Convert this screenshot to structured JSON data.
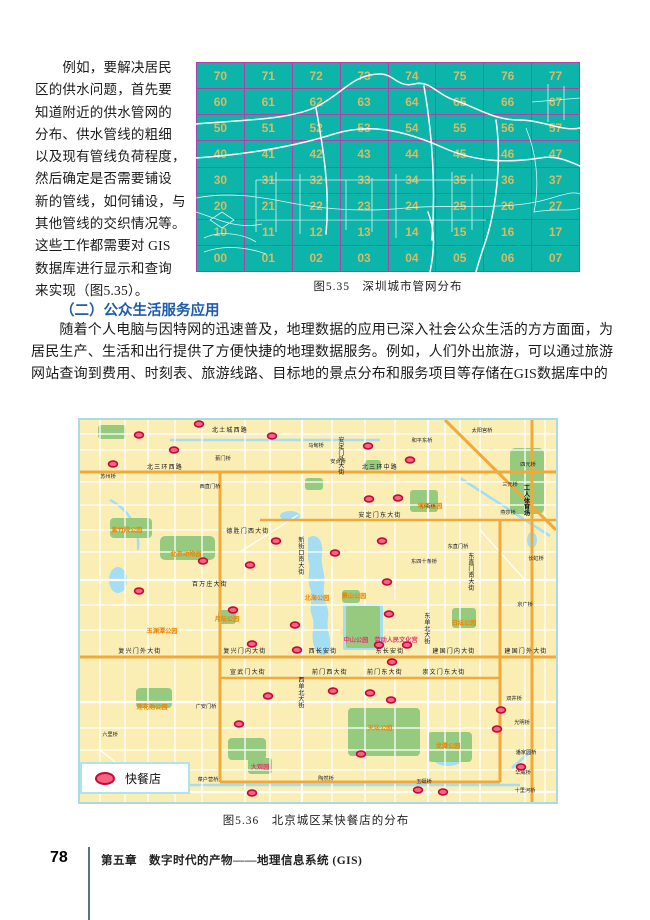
{
  "page": {
    "left_paragraph": "　　例如，要解决居民\n区的供水问题，首先要\n知道附近的供水管网的\n分布、供水管线的粗细\n以及现有管线负荷程度，\n然后确定是否需要铺设\n新的管线，如何铺设，与\n其他管线的交织情况等。\n这些工作都需要对 GIS\n数据库进行显示和查询\n来实现（图5.35）。",
    "section_heading": "（二）公众生活服务应用",
    "paragraph2": "　　随着个人电脑与因特网的迅速普及，地理数据的应用已深入社会公众生活的方方面面，为\n居民生产、生活和出行提供了方便快捷的地理数据服务。例如，人们外出旅游，可以通过旅游\n网站查询到费用、时刻表、旅游线路、目标地的景点分布和服务项目等存储在GIS数据库中的",
    "footer": {
      "page_number": "78",
      "chapter": "第五章　数字时代的产物——地理信息系统 (GIS)"
    }
  },
  "shenzhen_map": {
    "caption": "图5.35　深圳城市管网分布",
    "grid_numbers": [
      [
        "70",
        "71",
        "72",
        "73",
        "74",
        "75",
        "76",
        "77"
      ],
      [
        "60",
        "61",
        "62",
        "63",
        "64",
        "65",
        "66",
        "67"
      ],
      [
        "50",
        "51",
        "52",
        "53",
        "54",
        "55",
        "56",
        "57"
      ],
      [
        "40",
        "41",
        "42",
        "43",
        "44",
        "45",
        "46",
        "47"
      ],
      [
        "30",
        "31",
        "32",
        "33",
        "34",
        "35",
        "36",
        "37"
      ],
      [
        "20",
        "21",
        "22",
        "23",
        "24",
        "25",
        "26",
        "27"
      ],
      [
        "10",
        "11",
        "12",
        "13",
        "14",
        "15",
        "16",
        "17"
      ],
      [
        "00",
        "01",
        "02",
        "03",
        "04",
        "05",
        "06",
        "07"
      ]
    ],
    "colors": {
      "background": "#0cb4aa",
      "grid_line": "#b23fa5",
      "number": "#d4bc66",
      "pipes": "#ffffff"
    }
  },
  "beijing_map": {
    "caption": "图5.36　北京城区某快餐店的分布",
    "legend": {
      "label": "快餐店"
    },
    "colors": {
      "background": "#faeeb5",
      "park": "#96cb7f",
      "water": "#a5ddf3",
      "major_road": "#f2a93b",
      "marker_fill": "#f4647f",
      "marker_stroke": "#c40a3c",
      "park_label": "#f08300",
      "landmark_label": "#e43a6e"
    },
    "street_labels": [
      {
        "t": "北土城西路",
        "x": 150,
        "y": 12
      },
      {
        "t": "北三环西路",
        "x": 85,
        "y": 49
      },
      {
        "t": "北三环中路",
        "x": 300,
        "y": 49
      },
      {
        "t": "安定门东大街",
        "x": 300,
        "y": 97
      },
      {
        "t": "德胜门西大街",
        "x": 168,
        "y": 113
      },
      {
        "t": "百万庄大街",
        "x": 130,
        "y": 166
      },
      {
        "t": "复兴门外大街",
        "x": 60,
        "y": 233
      },
      {
        "t": "复兴门内大街",
        "x": 165,
        "y": 233
      },
      {
        "t": "西长安街",
        "x": 243,
        "y": 233
      },
      {
        "t": "东长安街",
        "x": 310,
        "y": 233
      },
      {
        "t": "建国门内大街",
        "x": 374,
        "y": 233
      },
      {
        "t": "建国门外大街",
        "x": 446,
        "y": 233
      },
      {
        "t": "宣武门大街",
        "x": 168,
        "y": 254
      },
      {
        "t": "前门西大街",
        "x": 250,
        "y": 254
      },
      {
        "t": "前门东大街",
        "x": 305,
        "y": 254
      },
      {
        "t": "崇文门东大街",
        "x": 364,
        "y": 254
      },
      {
        "t": "新街口南大街",
        "x": 222,
        "y": 122,
        "v": true
      },
      {
        "t": "安定门外大街",
        "x": 262,
        "y": 22,
        "v": true
      },
      {
        "t": "东直门南大街",
        "x": 392,
        "y": 138,
        "v": true
      },
      {
        "t": "东单北大街",
        "x": 348,
        "y": 198,
        "v": true
      },
      {
        "t": "西单北大街",
        "x": 222,
        "y": 262,
        "v": true
      }
    ],
    "bridge_labels": [
      {
        "t": "蓟门桥",
        "x": 143,
        "y": 40
      },
      {
        "t": "马甸桥",
        "x": 236,
        "y": 27
      },
      {
        "t": "安贞桥",
        "x": 258,
        "y": 43
      },
      {
        "t": "和平东桥",
        "x": 342,
        "y": 22
      },
      {
        "t": "太阳宫桥",
        "x": 402,
        "y": 12
      },
      {
        "t": "四元桥",
        "x": 448,
        "y": 46
      },
      {
        "t": "三元桥",
        "x": 430,
        "y": 66
      },
      {
        "t": "燕莎桥",
        "x": 428,
        "y": 94
      },
      {
        "t": "长虹桥",
        "x": 456,
        "y": 140
      },
      {
        "t": "小街桥",
        "x": 348,
        "y": 88
      },
      {
        "t": "东直门桥",
        "x": 378,
        "y": 128
      },
      {
        "t": "东四十条桥",
        "x": 344,
        "y": 143
      },
      {
        "t": "苏州桥",
        "x": 28,
        "y": 58
      },
      {
        "t": "西直门桥",
        "x": 130,
        "y": 68
      },
      {
        "t": "广安门桥",
        "x": 126,
        "y": 288
      },
      {
        "t": "六里桥",
        "x": 30,
        "y": 316
      },
      {
        "t": "菜户营桥",
        "x": 128,
        "y": 361
      },
      {
        "t": "陶然桥",
        "x": 246,
        "y": 360
      },
      {
        "t": "玉蜓桥",
        "x": 344,
        "y": 363
      },
      {
        "t": "光明桥",
        "x": 442,
        "y": 304
      },
      {
        "t": "双井桥",
        "x": 434,
        "y": 280
      },
      {
        "t": "潘家园桥",
        "x": 446,
        "y": 334
      },
      {
        "t": "华威桥",
        "x": 443,
        "y": 354
      },
      {
        "t": "十里河桥",
        "x": 445,
        "y": 372
      },
      {
        "t": "京广桥",
        "x": 445,
        "y": 186
      }
    ],
    "park_labels": [
      {
        "t": "紫竹院公园",
        "x": 47,
        "y": 112,
        "c": "orange"
      },
      {
        "t": "北京动物园",
        "x": 106,
        "y": 136,
        "c": "orange"
      },
      {
        "t": "地坛公园",
        "x": 350,
        "y": 88,
        "c": "orange"
      },
      {
        "t": "北海公园",
        "x": 237,
        "y": 180,
        "c": "orange"
      },
      {
        "t": "景山公园",
        "x": 274,
        "y": 178,
        "c": "orange"
      },
      {
        "t": "月坛公园",
        "x": 147,
        "y": 201,
        "c": "orange"
      },
      {
        "t": "玉渊潭公园",
        "x": 82,
        "y": 213,
        "c": "orange"
      },
      {
        "t": "日坛公园",
        "x": 384,
        "y": 205,
        "c": "orange"
      },
      {
        "t": "天坛公园",
        "x": 300,
        "y": 310,
        "c": "orange"
      },
      {
        "t": "龙潭公园",
        "x": 368,
        "y": 328,
        "c": "orange"
      },
      {
        "t": "莲花池公园",
        "x": 72,
        "y": 289,
        "c": "orange"
      },
      {
        "t": "中山公园",
        "x": 276,
        "y": 222,
        "c": "red"
      },
      {
        "t": "劳动人民文化宫",
        "x": 316,
        "y": 222,
        "c": "red"
      },
      {
        "t": "大观园",
        "x": 180,
        "y": 349,
        "c": "red"
      },
      {
        "t": "工人体育场",
        "x": 447,
        "y": 70,
        "c": "black",
        "v": true
      }
    ],
    "markers": [
      [
        119,
        4
      ],
      [
        59,
        15
      ],
      [
        94,
        30
      ],
      [
        33,
        44
      ],
      [
        192,
        16
      ],
      [
        288,
        26
      ],
      [
        330,
        40
      ],
      [
        289,
        79
      ],
      [
        318,
        78
      ],
      [
        196,
        121
      ],
      [
        255,
        133
      ],
      [
        302,
        121
      ],
      [
        123,
        141
      ],
      [
        170,
        145
      ],
      [
        307,
        162
      ],
      [
        59,
        171
      ],
      [
        153,
        190
      ],
      [
        309,
        194
      ],
      [
        215,
        205
      ],
      [
        172,
        224
      ],
      [
        217,
        230
      ],
      [
        327,
        225
      ],
      [
        312,
        242
      ],
      [
        299,
        225
      ],
      [
        188,
        276
      ],
      [
        253,
        271
      ],
      [
        290,
        273
      ],
      [
        311,
        280
      ],
      [
        159,
        304
      ],
      [
        281,
        334
      ],
      [
        421,
        290
      ],
      [
        417,
        309
      ],
      [
        441,
        347
      ],
      [
        338,
        370
      ],
      [
        363,
        372
      ],
      [
        172,
        373
      ]
    ]
  }
}
